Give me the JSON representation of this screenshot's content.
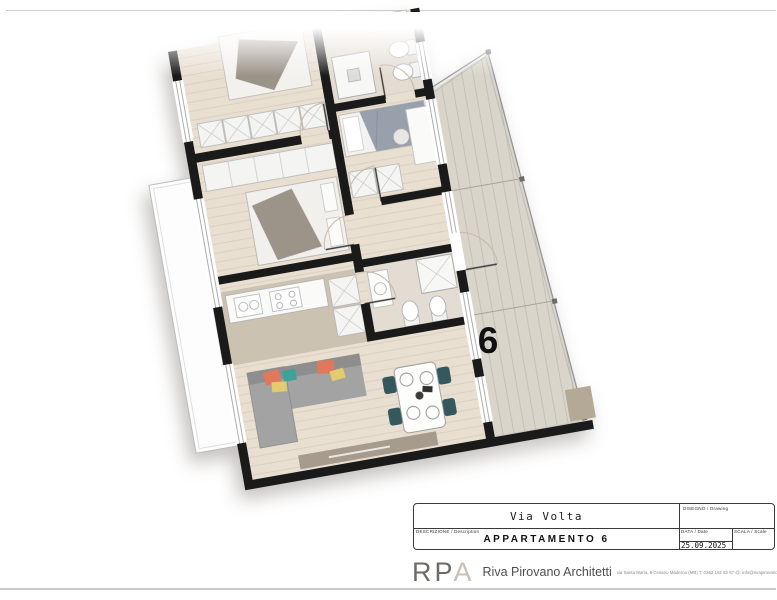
{
  "sheet": {
    "title_block": {
      "drawing_label": "DISEGNO / Drawing",
      "drawing_value": "Via Volta",
      "description_label": "DESCRIZIONE / Description",
      "description_value": "APPARTAMENTO 6",
      "date_label": "DATA / Date",
      "date_value": "25.09.2025",
      "scale_label": "SCALA / Scale",
      "scale_value": ""
    },
    "firm": {
      "logo_rp": "RP",
      "logo_a": "A",
      "name": "Riva Pirovano Architetti",
      "contact": "via Santa Maria, 9 Cesano Maderno (MB)   T: 0362 182 82 67   @: info@rivapirovanoarchitetti.it"
    }
  },
  "plan": {
    "unit_number": "6",
    "colors": {
      "wall": "#1a1a1a",
      "wood_floor": "#e8dfd1",
      "kitchen_floor": "#ccc2b1",
      "bath_floor": "#e3dcd2",
      "terrace_deck": "#d9d5cb",
      "sofa_gray": "#a3a3a3",
      "cushion_coral": "#e0795c",
      "cushion_teal": "#3aa39a",
      "cushion_yellow": "#e2cc6e",
      "chair_teal": "#34585c",
      "sideboard_taupe": "#a69b8c",
      "bed_throw_taupe": "#9c9489",
      "bed2_duvet": "#98a0ac"
    }
  }
}
